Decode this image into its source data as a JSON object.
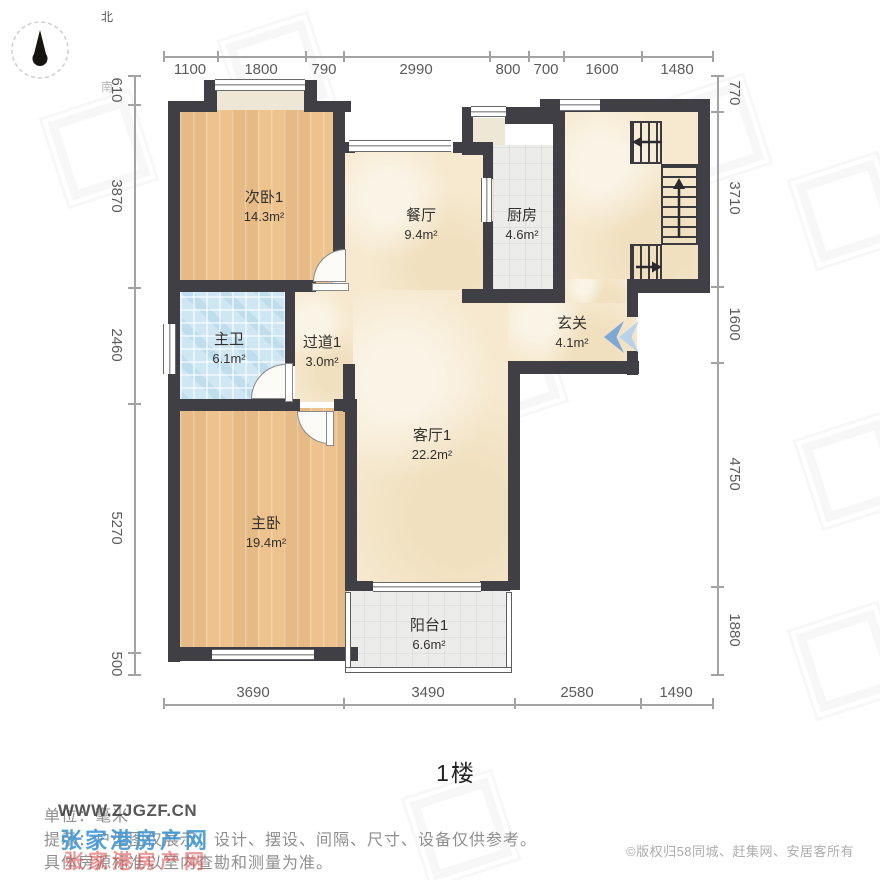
{
  "compass": {
    "north": "北",
    "south": "南"
  },
  "dimensions": {
    "top": [
      "1100",
      "1800",
      "790",
      "2990",
      "800",
      "700",
      "1600",
      "1480"
    ],
    "left": [
      "610",
      "3870",
      "2460",
      "5270",
      "500"
    ],
    "right": [
      "770",
      "3710",
      "1600",
      "4750",
      "1880"
    ],
    "bottom": [
      "3690",
      "3490",
      "2580",
      "1490"
    ]
  },
  "rooms": {
    "bed2": {
      "name": "次卧1",
      "area": "14.3m²"
    },
    "dining": {
      "name": "餐厅",
      "area": "9.4m²"
    },
    "kitchen": {
      "name": "厨房",
      "area": "4.6m²"
    },
    "bath": {
      "name": "主卫",
      "area": "6.1m²"
    },
    "hallway": {
      "name": "过道1",
      "area": "3.0m²"
    },
    "entry": {
      "name": "玄关",
      "area": "4.1m²"
    },
    "living": {
      "name": "客厅1",
      "area": "22.2m²"
    },
    "master": {
      "name": "主卧",
      "area": "19.4m²"
    },
    "balcony": {
      "name": "阳台1",
      "area": "6.6m²"
    }
  },
  "floor_label": "1楼",
  "footer": {
    "unit": "单位：毫米",
    "tip": "提示：户型图仅展示，设计、摆设、间隔、尺寸、设备仅供参考。",
    "tip2": "具体房源标准以室内查勘和测量为准。",
    "copyright": "©版权归58同城、赶集网、安居客所有"
  },
  "watermarks": {
    "site": "WWW.ZJGZF.CN",
    "name_blue": "张家港房产网",
    "name_red": "张家港房产网"
  },
  "colors": {
    "wall": "#3f3f45",
    "wood_floor": "#edc28d",
    "marble_floor": "#f6e9cf",
    "tile_floor": "#ececea",
    "bath_tile": "#cfe7f3",
    "entry_arrow_blue": "#7ea8d4",
    "watermark_blue": "#3f97d4",
    "watermark_red": "#e04444"
  }
}
